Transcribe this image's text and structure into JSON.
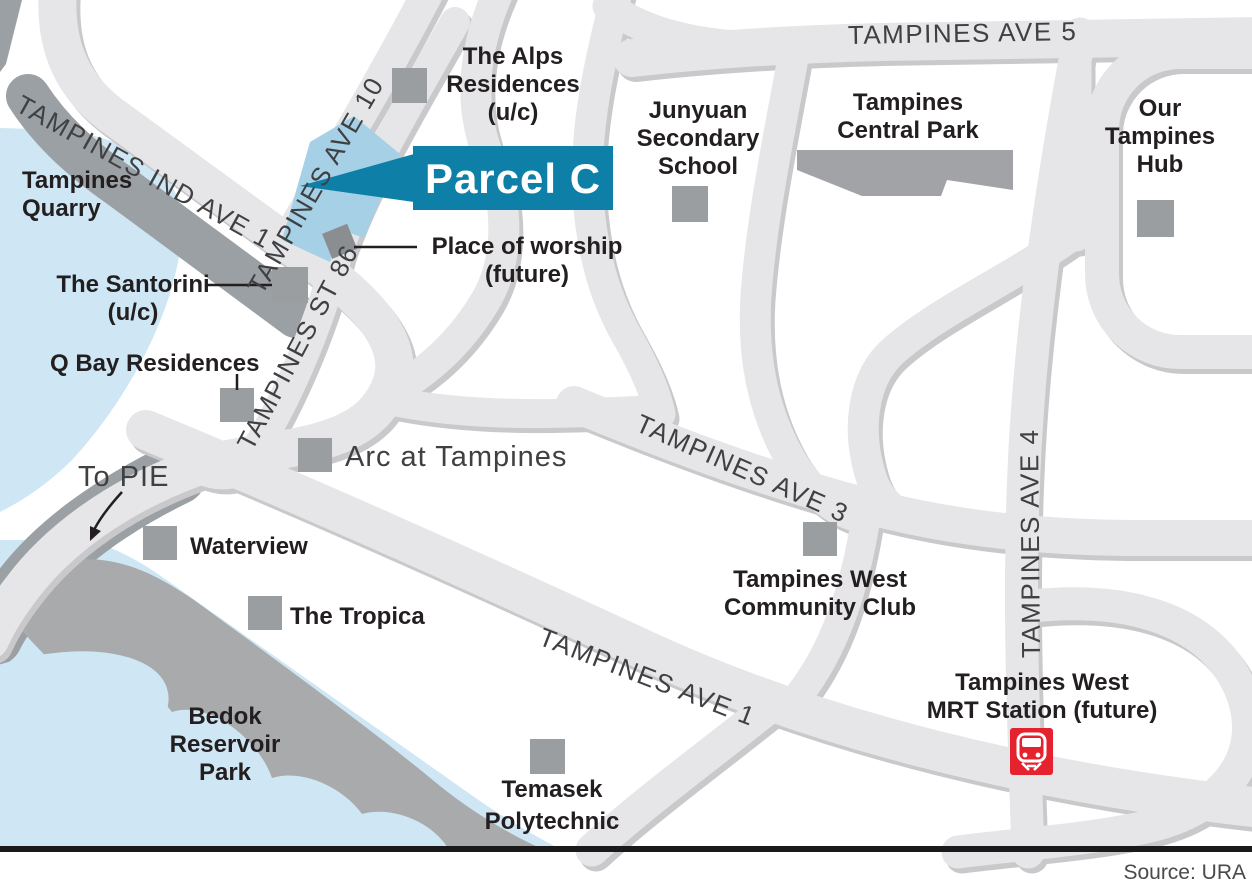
{
  "callout": {
    "label": "Parcel C"
  },
  "roads": {
    "ave5": "TAMPINES AVE 5",
    "ind_ave1": "TAMPINES IND AVE 1",
    "ave10": "TAMPINES AVE 10",
    "st86": "TAMPINES ST 86",
    "ave3": "TAMPINES AVE 3",
    "ave4": "TAMPINES AVE 4",
    "ave1": "TAMPINES AVE 1"
  },
  "places": {
    "quarry_1": "Tampines",
    "quarry_2": "Quarry",
    "alps_1": "The Alps",
    "alps_2": "Residences",
    "alps_3": "(u/c)",
    "junyuan_1": "Junyuan",
    "junyuan_2": "Secondary",
    "junyuan_3": "School",
    "central_park_1": "Tampines",
    "central_park_2": "Central Park",
    "hub_1": "Our",
    "hub_2": "Tampines",
    "hub_3": "Hub",
    "worship_1": "Place of worship",
    "worship_2": "(future)",
    "santorini_1": "The Santorini",
    "santorini_2": "(u/c)",
    "qbay": "Q Bay Residences",
    "arc": "Arc at Tampines",
    "to_pie": "To PIE",
    "waterview": "Waterview",
    "tropica": "The Tropica",
    "bedok_1": "Bedok",
    "bedok_2": "Reservoir",
    "bedok_3": "Park",
    "temasek_1": "Temasek",
    "temasek_2": "Polytechnic",
    "club_1": "Tampines West",
    "club_2": "Community Club",
    "mrt_1": "Tampines West",
    "mrt_2": "MRT Station (future)"
  },
  "footer": {
    "source": "Source: URA"
  },
  "colors": {
    "road": "#e6e6e8",
    "road_shadow": "#c9c9cb",
    "gray_band": "#9ba0a4",
    "water": "#cfe7f4",
    "park": "#a1a3a6",
    "bedok_park": "#a8aaac",
    "marker": "#9b9ea1",
    "worship": "#8b8e91",
    "parcel": "#a6d0e6",
    "callout": "#0e7fa6",
    "mrt_red": "#e5232e",
    "text": "#231f20",
    "road_text": "#3f4042"
  }
}
